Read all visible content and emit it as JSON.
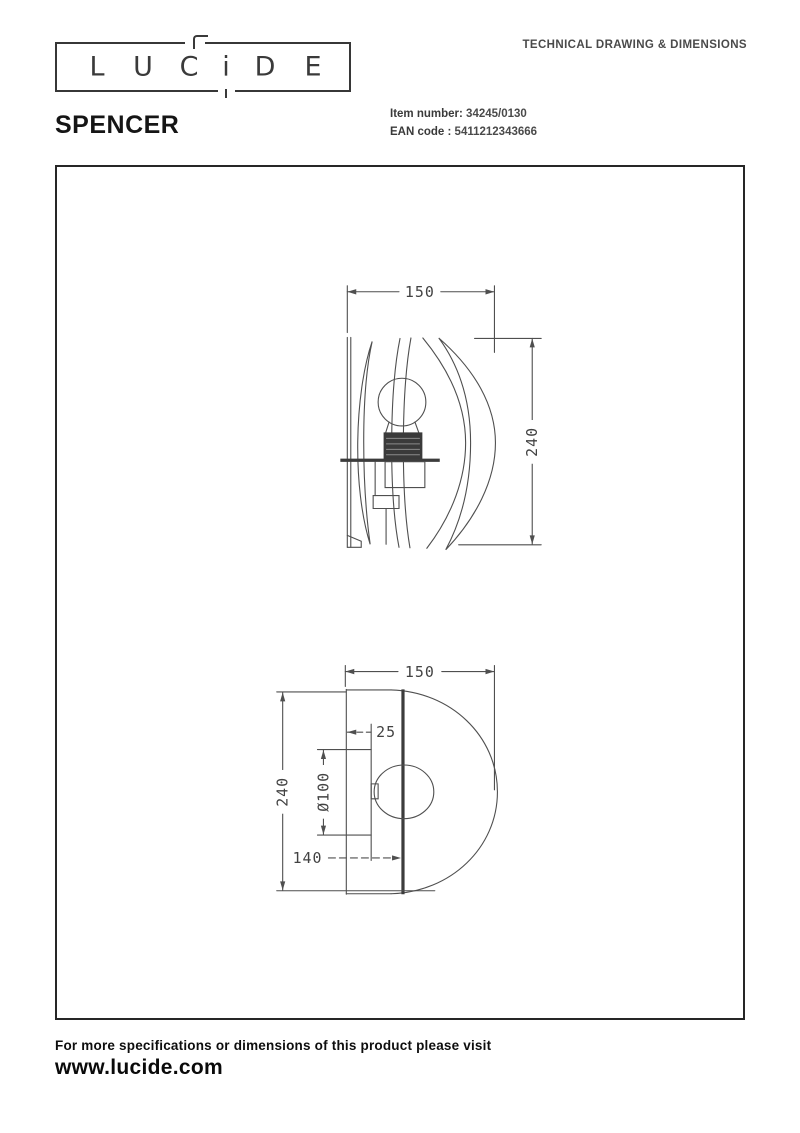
{
  "header": {
    "logo_letters": [
      "L",
      "U",
      "C",
      "i",
      "D",
      "E"
    ],
    "doc_title": "TECHNICAL DRAWING & DIMENSIONS"
  },
  "product": {
    "name": "SPENCER",
    "item_number_label": "Item number:",
    "item_number": "34245/0130",
    "ean_label": "EAN code :",
    "ean_code": "5411212343666"
  },
  "drawings": {
    "side_view": {
      "width_mm": "150",
      "height_mm": "240"
    },
    "front_view": {
      "width_mm": "150",
      "height_mm": "240",
      "inset_mm": "25",
      "hole_diameter": "Ø100",
      "center_height_mm": "140"
    }
  },
  "footer": {
    "note": "For more specifications or dimensions of this product please visit",
    "website": "www.lucide.com"
  },
  "colors": {
    "line": "#4f4f4f",
    "text_dark": "#1f1f1f",
    "dim_text": "#424242"
  }
}
